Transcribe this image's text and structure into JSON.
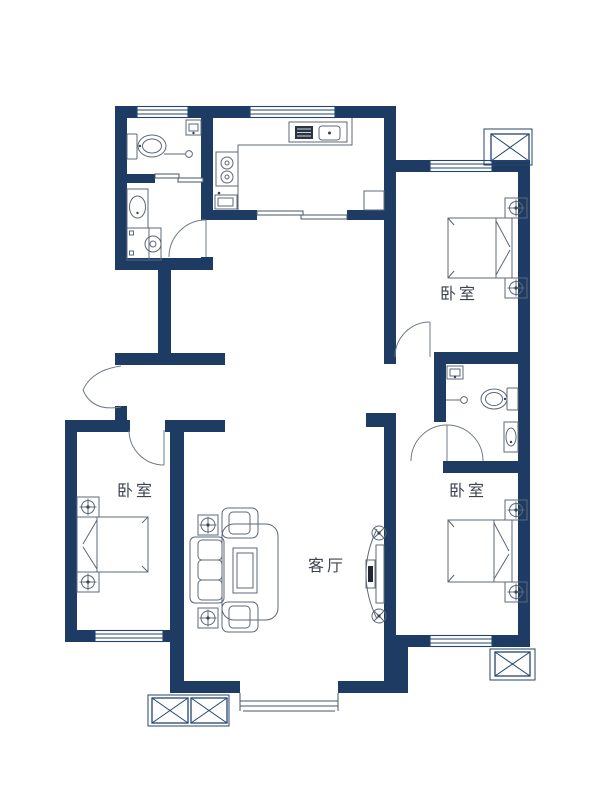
{
  "palette": {
    "wall": "#1e3c63",
    "window_line": "#24446e",
    "furniture_line": "#5c6877",
    "door_arc": "#707a88",
    "label_text": "#3c4350",
    "background": "#ffffff"
  },
  "rooms": {
    "bedroom_north": {
      "label": "卧室"
    },
    "bedroom_southwest": {
      "label": "卧室"
    },
    "bedroom_southeast": {
      "label": "卧室"
    },
    "living_room": {
      "label": "客厅"
    }
  },
  "fixtures": [
    "toilet-icon",
    "washbasin-icon",
    "shower-icon",
    "washing-machine-icon",
    "vanity-sink-icon",
    "stove-icon",
    "kitchen-sink-icon",
    "fridge-icon",
    "counter-icon",
    "bed-icon",
    "nightstand-lamp-icon",
    "sofa-icon",
    "armchair-icon",
    "coffee-table-icon",
    "rug-icon",
    "tv-cabinet-icon",
    "speaker-icon",
    "plant-pot-icon",
    "ac-platform-icon",
    "bay-window-icon",
    "sliding-door-icon",
    "swing-door-icon",
    "window-icon"
  ]
}
